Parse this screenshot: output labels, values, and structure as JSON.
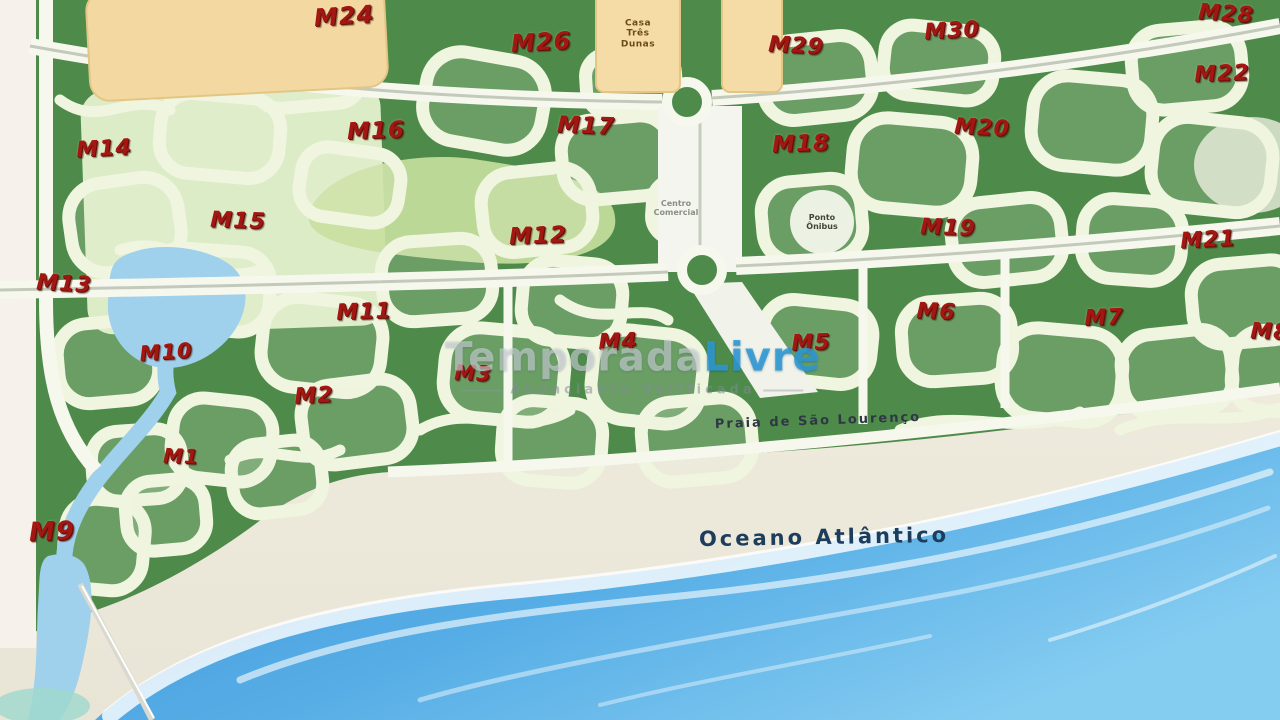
{
  "map": {
    "module_labels": [
      {
        "text": "M24",
        "x": 344,
        "y": 16,
        "size": 24,
        "rot": -4
      },
      {
        "text": "M26",
        "x": 541,
        "y": 42,
        "size": 24,
        "rot": -3
      },
      {
        "text": "M29",
        "x": 796,
        "y": 46,
        "size": 22,
        "rot": 3
      },
      {
        "text": "M30",
        "x": 952,
        "y": 31,
        "size": 22,
        "rot": -3
      },
      {
        "text": "M28",
        "x": 1226,
        "y": 14,
        "size": 22,
        "rot": 4
      },
      {
        "text": "M22",
        "x": 1222,
        "y": 74,
        "size": 22,
        "rot": -2
      },
      {
        "text": "M20",
        "x": 982,
        "y": 128,
        "size": 22,
        "rot": 3
      },
      {
        "text": "M14",
        "x": 104,
        "y": 149,
        "size": 22,
        "rot": -3
      },
      {
        "text": "M16",
        "x": 376,
        "y": 131,
        "size": 23,
        "rot": -2
      },
      {
        "text": "M17",
        "x": 586,
        "y": 126,
        "size": 23,
        "rot": 2
      },
      {
        "text": "M18",
        "x": 801,
        "y": 144,
        "size": 23,
        "rot": -2
      },
      {
        "text": "M15",
        "x": 238,
        "y": 221,
        "size": 22,
        "rot": 2
      },
      {
        "text": "M12",
        "x": 538,
        "y": 236,
        "size": 23,
        "rot": -2
      },
      {
        "text": "M21",
        "x": 1208,
        "y": 240,
        "size": 22,
        "rot": -3
      },
      {
        "text": "M13",
        "x": 64,
        "y": 284,
        "size": 22,
        "rot": 3
      },
      {
        "text": "M11",
        "x": 364,
        "y": 312,
        "size": 22,
        "rot": -2
      },
      {
        "text": "M19",
        "x": 948,
        "y": 228,
        "size": 22,
        "rot": 2
      },
      {
        "text": "M10",
        "x": 166,
        "y": 352,
        "size": 21,
        "rot": -4
      },
      {
        "text": "M5",
        "x": 811,
        "y": 343,
        "size": 22,
        "rot": -2
      },
      {
        "text": "M6",
        "x": 936,
        "y": 312,
        "size": 22,
        "rot": 2
      },
      {
        "text": "M7",
        "x": 1104,
        "y": 318,
        "size": 22,
        "rot": -2
      },
      {
        "text": "M8",
        "x": 1270,
        "y": 332,
        "size": 22,
        "rot": 2
      },
      {
        "text": "M2",
        "x": 314,
        "y": 396,
        "size": 22,
        "rot": -3
      },
      {
        "text": "M3",
        "x": 473,
        "y": 373,
        "size": 21,
        "rot": 2
      },
      {
        "text": "M4",
        "x": 618,
        "y": 342,
        "size": 22,
        "rot": -2
      },
      {
        "text": "M1",
        "x": 181,
        "y": 456,
        "size": 20,
        "rot": 2
      },
      {
        "text": "M9",
        "x": 52,
        "y": 532,
        "size": 26,
        "rot": -2
      }
    ],
    "place_labels": [
      {
        "text": "Praia de São Lourenço",
        "x": 818,
        "y": 421,
        "kind": "beach",
        "rot": -2
      },
      {
        "text": "Oceano Atlântico",
        "x": 824,
        "y": 537,
        "kind": "ocean",
        "rot": -1
      }
    ],
    "building_label": {
      "0": "Casa",
      "1": "Três",
      "2": "Dunas"
    },
    "boulevard_label": {
      "0": "Centro",
      "1": "Comercial"
    },
    "kiosk_label": {
      "0": "Ponto",
      "1": "Ônibus"
    },
    "colors": {
      "land_green": "#4e8b4b",
      "block_cream": "#eff5df",
      "park_green": "#dcecc7",
      "golf_green": "#c9e09f",
      "water_blue": "#9fd0ec",
      "ocean_dark": "#3d92d6",
      "ocean_light": "#85ccf1",
      "sand": "#efecdf",
      "building_yellow": "#f3d9a1",
      "label_red": "#a31712",
      "watermark_blue": "#2e99d6"
    }
  },
  "watermark": {
    "brand_light": "Temporada",
    "brand_accent": "Livre",
    "subtitle": "Anunciante Verificada"
  }
}
